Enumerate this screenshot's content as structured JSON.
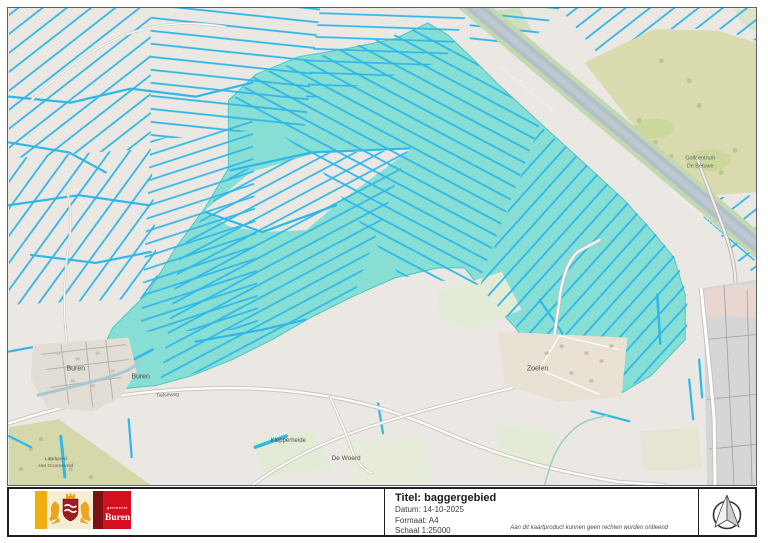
{
  "title_block": {
    "title": "Titel: baggergebied",
    "date": "Datum: 14-10-2025",
    "format": "Formaat: A4",
    "scale": "Schaal 1:25000",
    "disclaimer": "Aan dit kaartproduct kunnen geen rechten worden ontleend"
  },
  "logo": {
    "org_prefix": "gemeente",
    "org_name": "Buren"
  },
  "map": {
    "labels": {
      "buren": "Buren",
      "buren2": "Buren",
      "tielseweg": "Tielseweg",
      "klepperheide": "Klepperheide",
      "de_woerd": "De Woerd",
      "zoelen": "Zoelen",
      "golf_line1": "Golfcentrum",
      "golf_line2": "De Betuwe",
      "estate_line1": "Landgoed",
      "estate_line2": "Het Groeneveld",
      "canal_name": "Amsterdam-Rijnkanaal"
    },
    "colors": {
      "background": "#ebe8e3",
      "ditch_blue": "#2fb7e8",
      "dredge_area": "#86ded5",
      "canal_water": "#b3bfc8",
      "canal_bank": "#c2d8b0",
      "golf_green": "#dadcb0",
      "urban_gray": "#d6d6d6",
      "village_beige": "#e9e1d4"
    }
  }
}
